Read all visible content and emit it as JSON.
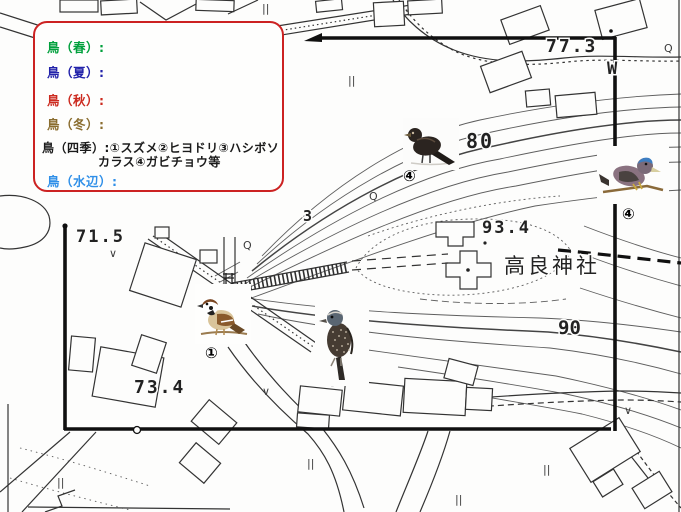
{
  "legend": {
    "items": [
      {
        "id": "spring",
        "label": "鳥（春）:",
        "color": "#00a03c"
      },
      {
        "id": "summer",
        "label": "鳥（夏）:",
        "color": "#2222aa"
      },
      {
        "id": "autumn",
        "label": "鳥（秋）:",
        "color": "#cc2a1f"
      },
      {
        "id": "winter",
        "label": "鳥（冬）:",
        "color": "#8a6d2f"
      },
      {
        "id": "all-seasons",
        "label": "鳥（四季）:①スズメ②ヒヨドリ③ハシボソ",
        "label_line2": "カラス④ガビチョウ等",
        "color": "#1a1a1a"
      },
      {
        "id": "waterside",
        "label": "鳥（水辺）:",
        "color": "#2f8fe8"
      }
    ]
  },
  "map": {
    "labels": {
      "e773": "77.3",
      "w_mark": "W",
      "e80": "80",
      "e934": "93.4",
      "shrine_name": "高良神社",
      "e90": "90",
      "e715": "71.5",
      "e734": "73.4",
      "e3": "3"
    },
    "symbols": {
      "q": "Q",
      "tick": "||",
      "check": "∨"
    },
    "markers": {
      "dark_bird": "④",
      "blue_bird": "④",
      "sparrow": "①",
      "speckled_bird": "④"
    },
    "colors": {
      "boundary": "#101010",
      "contour": "#4d4d4d",
      "teal_road": "#2e8b7a",
      "legend_border": "#cc2222"
    }
  }
}
